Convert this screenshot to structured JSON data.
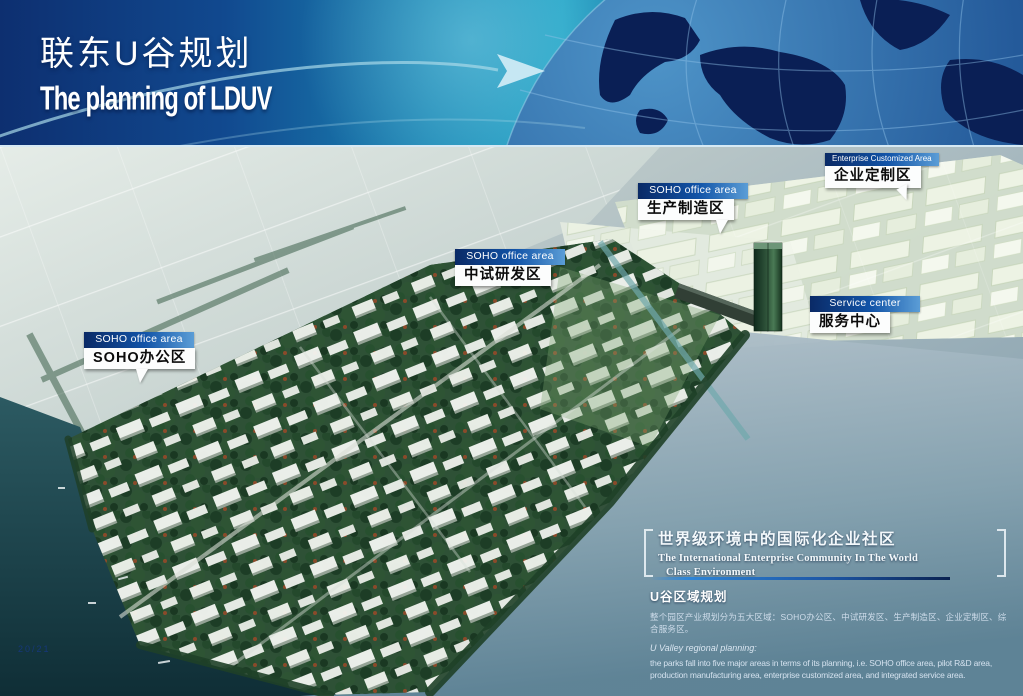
{
  "page": {
    "page_number": "20/21"
  },
  "header": {
    "title_zh": "联东U谷规划",
    "title_en": "The planning of LDUV"
  },
  "map": {
    "labels": [
      {
        "id": "production",
        "tag": "SOHO office area",
        "name_zh": "生产制造区"
      },
      {
        "id": "pilot-rd",
        "tag": "SOHO office area",
        "name_zh": "中试研发区"
      },
      {
        "id": "soho-office",
        "tag": "SOHO office area",
        "name_zh": "SOHO办公区"
      },
      {
        "id": "enterprise",
        "tag": "Enterprise Customized Area",
        "name_zh": "企业定制区"
      },
      {
        "id": "service",
        "tag": "Service center",
        "name_zh": "服务中心"
      }
    ]
  },
  "footer": {
    "slogan_zh": "世界级环境中的国际化企业社区",
    "slogan_en_line1": "The International Enterprise Community In The World",
    "slogan_en_line2": "Class Environment",
    "section_title": "U谷区域规划",
    "desc_zh": "整个园区产业规划分为五大区域：SOHO办公区、中试研发区、生产制造区、企业定制区、综合服务区。",
    "desc_en_label": "U Valley regional planning:",
    "desc_en": "the parks fall into five major areas in terms of its planning, i.e. SOHO office area, pilot R&D area, production manufacturing area, enterprise customized area, and integrated service area."
  },
  "colors": {
    "header_navy": "#0d2f70",
    "header_teal": "#23a4c6",
    "label_bar_blue": "#1254a8",
    "rule_blue": "#2f86d8",
    "water_dark": "#0f2e36",
    "park_green": "#2e5136"
  }
}
